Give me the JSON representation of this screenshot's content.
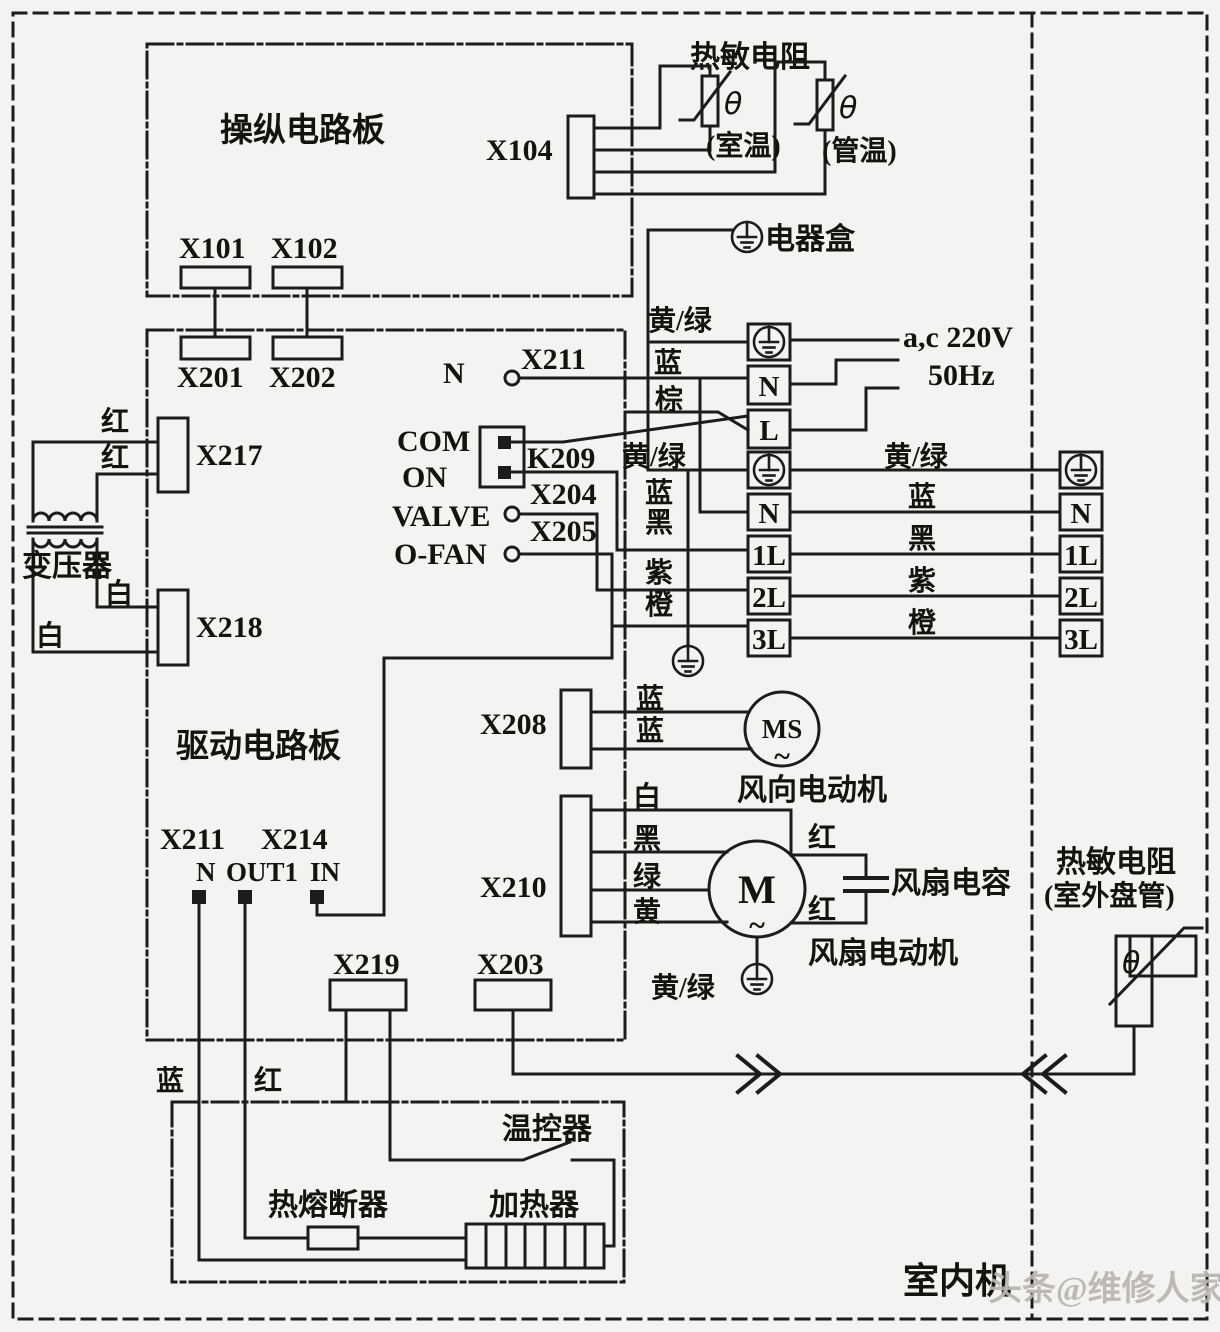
{
  "colors": {
    "line": "#1c1c1a",
    "background": "#f4f3f1",
    "watermark": "#b9b6b1"
  },
  "labels": {
    "controlBoard": "操纵电路板",
    "driveBoard": "驱动电路板",
    "thermTitle": "热敏电阻",
    "theta1": "θ",
    "theta2": "θ",
    "thetaOut": "θ",
    "roomTemp": "(室温)",
    "pipeTemp": "(管温)",
    "elecBox": "电器盒",
    "x101": "X101",
    "x102": "X102",
    "x201": "X201",
    "x202": "X202",
    "x104": "X104",
    "nNode": "N",
    "x211Top": "X211",
    "ygTop": "黄/绿",
    "blueTop": "蓝",
    "brownTop": "棕",
    "acv": "a,c 220V",
    "hz": "50Hz",
    "com": "COM",
    "on": "ON",
    "valve": "VALVE",
    "ofan": "O-FAN",
    "k209": "K209",
    "x204": "X204",
    "x205": "X205",
    "ygMid": "黄/绿",
    "blueMid": "蓝",
    "blackMid": "黑",
    "purpleMid": "紫",
    "orangeMid": "橙",
    "ygRight": "黄/绿",
    "blueRight": "蓝",
    "blackRight": "黑",
    "purpleRight": "紫",
    "orangeRight": "橙",
    "b1n": "N",
    "b1l": "L",
    "b2n": "N",
    "b2l1": "1L",
    "b2l2": "2L",
    "b2l3": "3L",
    "b3n": "N",
    "b3l1": "1L",
    "b3l2": "2L",
    "b3l3": "3L",
    "transformer": "变压器",
    "red1": "红",
    "red2": "红",
    "white1": "白",
    "white2": "白",
    "x217": "X217",
    "x218": "X218",
    "x208": "X208",
    "x210": "X210",
    "ms": "MS",
    "msTilde": "~",
    "m": "M",
    "mTilde": "~",
    "swingMotor": "风向电动机",
    "fanMotor": "风扇电动机",
    "fanCap": "风扇电容",
    "blueMs1": "蓝",
    "blueMs2": "蓝",
    "whiteM": "白",
    "blackM": "黑",
    "greenM": "绿",
    "yellowM": "黄",
    "redM1": "红",
    "redM2": "红",
    "ygM": "黄/绿",
    "x211Bottom": "X211",
    "x214": "X214",
    "nTerm": "N",
    "out1Term": "OUT1",
    "inTerm": "IN",
    "x219": "X219",
    "x203": "X203",
    "blueBottom": "蓝",
    "redBottom": "红",
    "thermostat": "温控器",
    "thermalFuse": "热熔断器",
    "heater": "加热器",
    "outThermLine1": "热敏电阻",
    "outThermLine2": "(室外盘管)",
    "indoorUnit": "室内机",
    "watermark": "头条@维修人家"
  }
}
